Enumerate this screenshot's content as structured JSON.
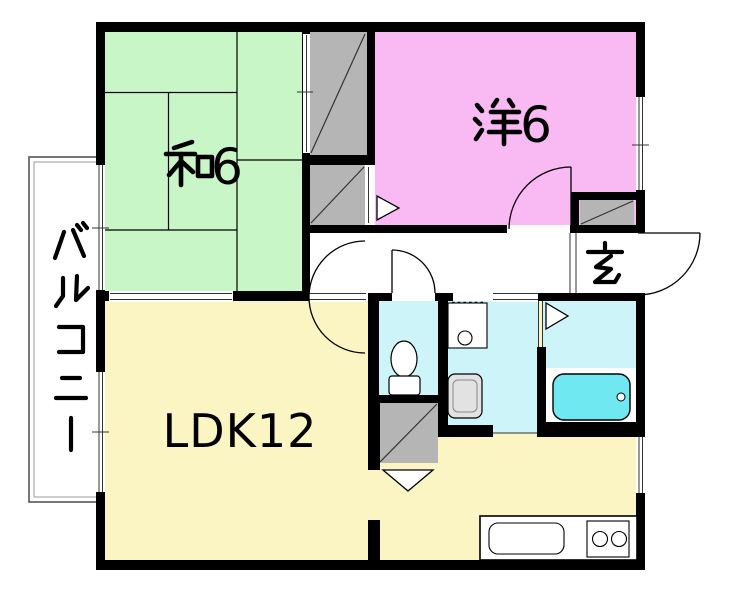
{
  "document": {
    "type": "apartment-floor-plan",
    "background": "#ffffff",
    "wall_color": "#000000"
  },
  "rooms": {
    "washitsu": {
      "label": "和6",
      "kanji": "和",
      "number": "6",
      "meaning": "japanese-style-room-6-tatami",
      "floor_color": "#c9f6c6"
    },
    "youshitsu": {
      "label": "洋6",
      "kanji": "洋",
      "number": "6",
      "meaning": "western-style-room-6-tatami",
      "floor_color": "#f9b9f2"
    },
    "ldk": {
      "label": "LDK12",
      "meaning": "living-dining-kitchen-12-tatami",
      "floor_color": "#faf5c2"
    },
    "genkan": {
      "label": "玄",
      "meaning": "entrance-hall",
      "floor_color": "#ffffff"
    },
    "balcony": {
      "label": "バルコニー",
      "chars": [
        "バ",
        "ル",
        "コ",
        "ニ",
        "ー"
      ],
      "meaning": "balcony",
      "floor_color": "#ffffff"
    },
    "sanitary": {
      "floor_color": "#cdf4f8",
      "bathtub_color": "#6fe8f1",
      "closet_color": "#b5b5b5",
      "appliance_color": "#e2e2e2"
    }
  },
  "fixtures": {
    "toilet": "toilet",
    "washbasin": "washbasin",
    "washing_machine": "washing-machine",
    "bathtub": "bathtub",
    "kitchen_sink": "kitchen-sink",
    "stove": "two-burner-stove",
    "shoe_cabinet": "shoe-cabinet",
    "closet_upper": "oshiire-closet",
    "closet_lower": "closet",
    "storage": "storage-closet"
  }
}
